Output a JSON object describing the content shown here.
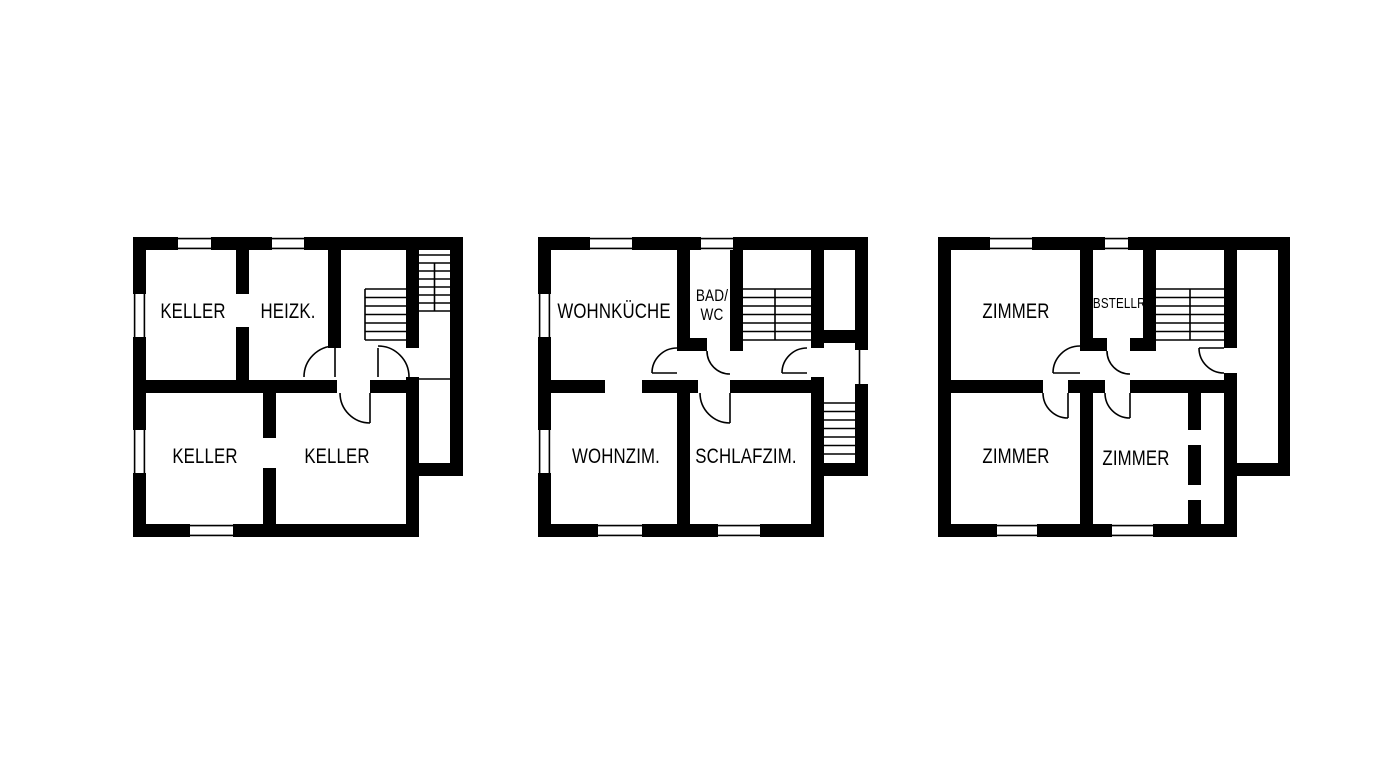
{
  "canvas": {
    "width": 1376,
    "height": 768,
    "background": "#ffffff",
    "line_color": "#000000"
  },
  "floors": [
    {
      "name": "basement-plan",
      "rooms": [
        {
          "key": "keller_nw",
          "label": "KELLER"
        },
        {
          "key": "heizk",
          "label": "HEIZK."
        },
        {
          "key": "keller_sw",
          "label": "KELLER"
        },
        {
          "key": "keller_se",
          "label": "KELLER"
        }
      ]
    },
    {
      "name": "ground-floor-plan",
      "rooms": [
        {
          "key": "wohnkueche",
          "label": "WOHNKÜCHE"
        },
        {
          "key": "bad_wc",
          "label_line1": "BAD/",
          "label_line2": "WC"
        },
        {
          "key": "wohnzim",
          "label": "WOHNZIM."
        },
        {
          "key": "schlafzim",
          "label": "SCHLAFZIM."
        }
      ]
    },
    {
      "name": "upper-floor-plan",
      "rooms": [
        {
          "key": "zimmer_nw",
          "label": "ZIMMER"
        },
        {
          "key": "abstellr",
          "label": "ABSTELLR."
        },
        {
          "key": "zimmer_sw",
          "label": "ZIMMER"
        },
        {
          "key": "zimmer_se",
          "label": "ZIMMER"
        }
      ]
    }
  ]
}
